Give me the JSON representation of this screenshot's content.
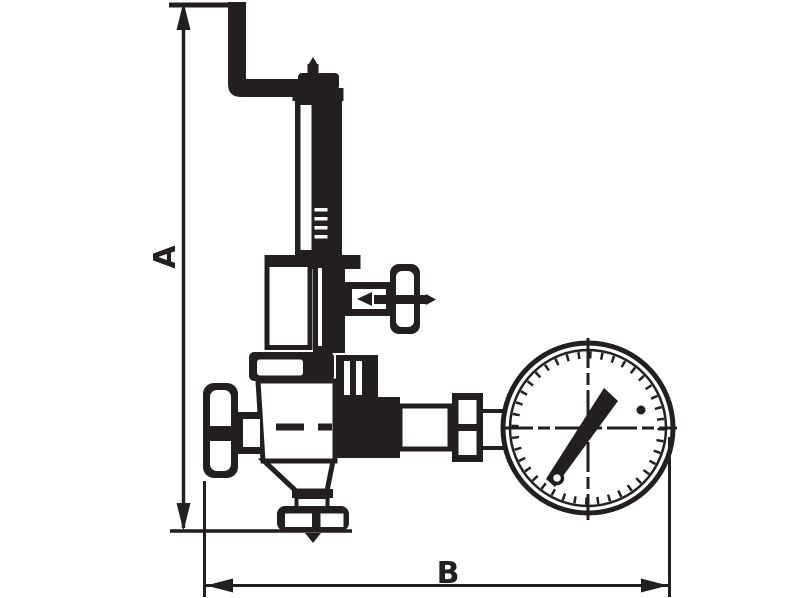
{
  "drawing": {
    "background_color": "#ffffff",
    "ink_color": "#231f20",
    "dimension_labels": {
      "a": "A",
      "b": "B"
    },
    "parts": [
      "vent-pipe",
      "spring-bonnet",
      "spring-housing",
      "side-valve-handwheel",
      "valve-body",
      "inlet-handwheel",
      "outlet-flange",
      "gauge-fittings",
      "pressure-gauge"
    ]
  }
}
